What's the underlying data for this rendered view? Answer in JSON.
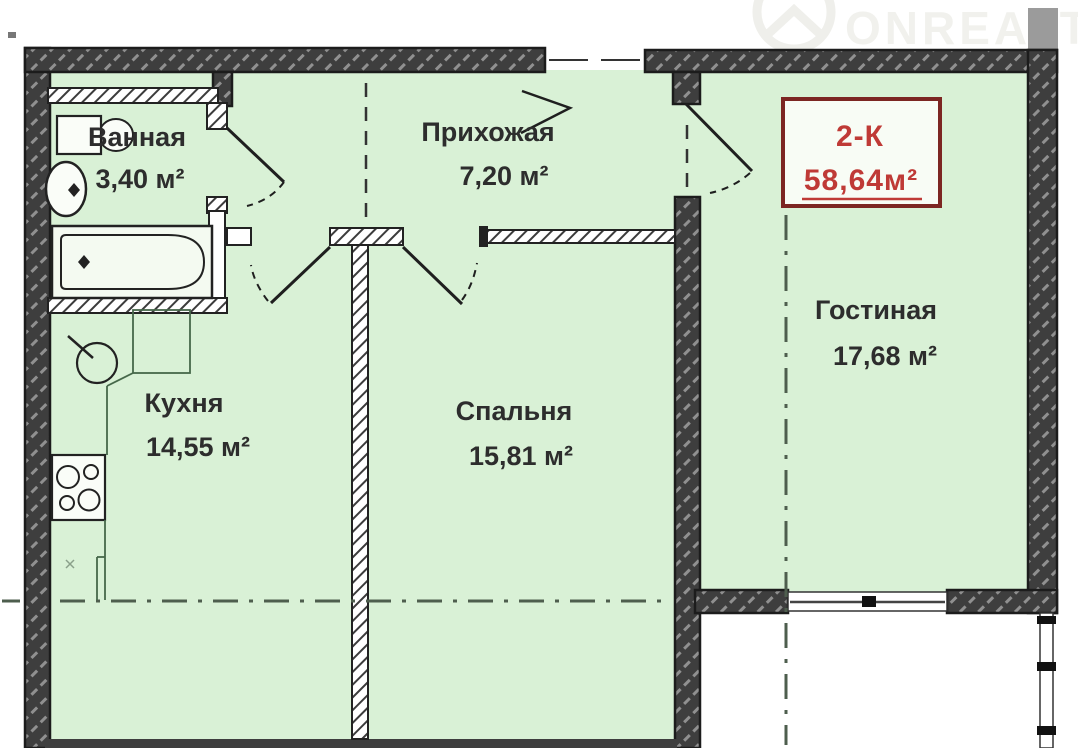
{
  "plan": {
    "apartment": {
      "type": "2-К",
      "area": "58,64м²"
    },
    "rooms": [
      {
        "name": "Ванная",
        "area": "3,40 м²"
      },
      {
        "name": "Прихожая",
        "area": "7,20 м²"
      },
      {
        "name": "Кухня",
        "area": "14,55 м²"
      },
      {
        "name": "Спальня",
        "area": "15,81 м²"
      },
      {
        "name": "Гостиная",
        "area": "17,68 м²"
      }
    ],
    "watermark": "ONREALT",
    "colors": {
      "room_fill": "#d9f1d6",
      "wall_dark": "#3e3e3e",
      "label_text": "#2d2d2d",
      "accent_red": "#bf3a36",
      "accent_red_border": "#7c2622"
    }
  }
}
